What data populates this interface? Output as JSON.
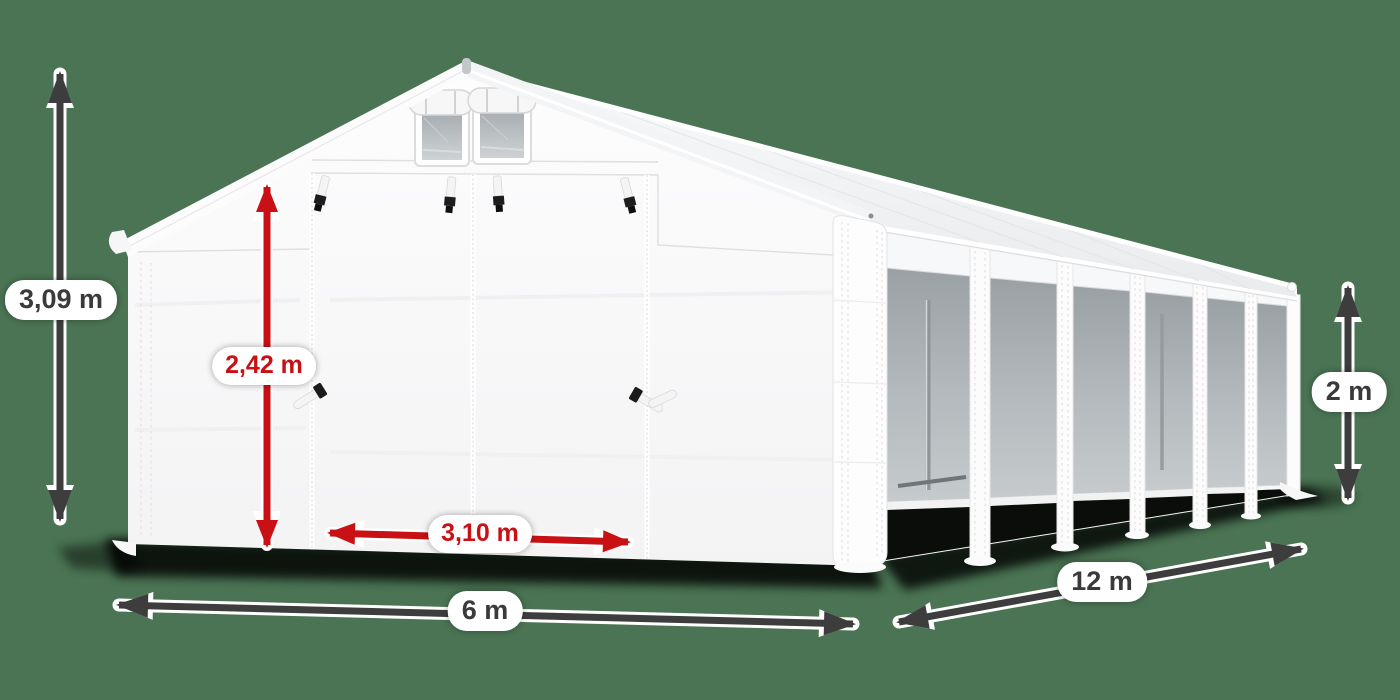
{
  "background": {
    "color": "#4a7453"
  },
  "palette": {
    "bg": "#4a7453",
    "arrow_dark": "#3d3d3d",
    "dim_red": "#c91015",
    "pill_bg": "#ffffff",
    "pill_text": "#3a3a3a"
  },
  "illustration": {
    "subject": "white-storage-tent",
    "faces": [
      "gable-front-with-double-door",
      "side-wall-with-6-mesh-windows"
    ],
    "features": [
      "two-gable-vents-with-rolled-covers",
      "strap-buckles-above-door",
      "door-toggle-handles",
      "corner-posts"
    ]
  },
  "dimensions": {
    "total_height": {
      "text": "3,09 m",
      "style": "dark"
    },
    "door_height": {
      "text": "2,42 m",
      "style": "red"
    },
    "door_width": {
      "text": "3,10 m",
      "style": "red"
    },
    "front_width": {
      "text": "6 m",
      "style": "dark"
    },
    "side_length": {
      "text": "12 m",
      "style": "dark"
    },
    "side_height": {
      "text": "2 m",
      "style": "dark"
    }
  }
}
